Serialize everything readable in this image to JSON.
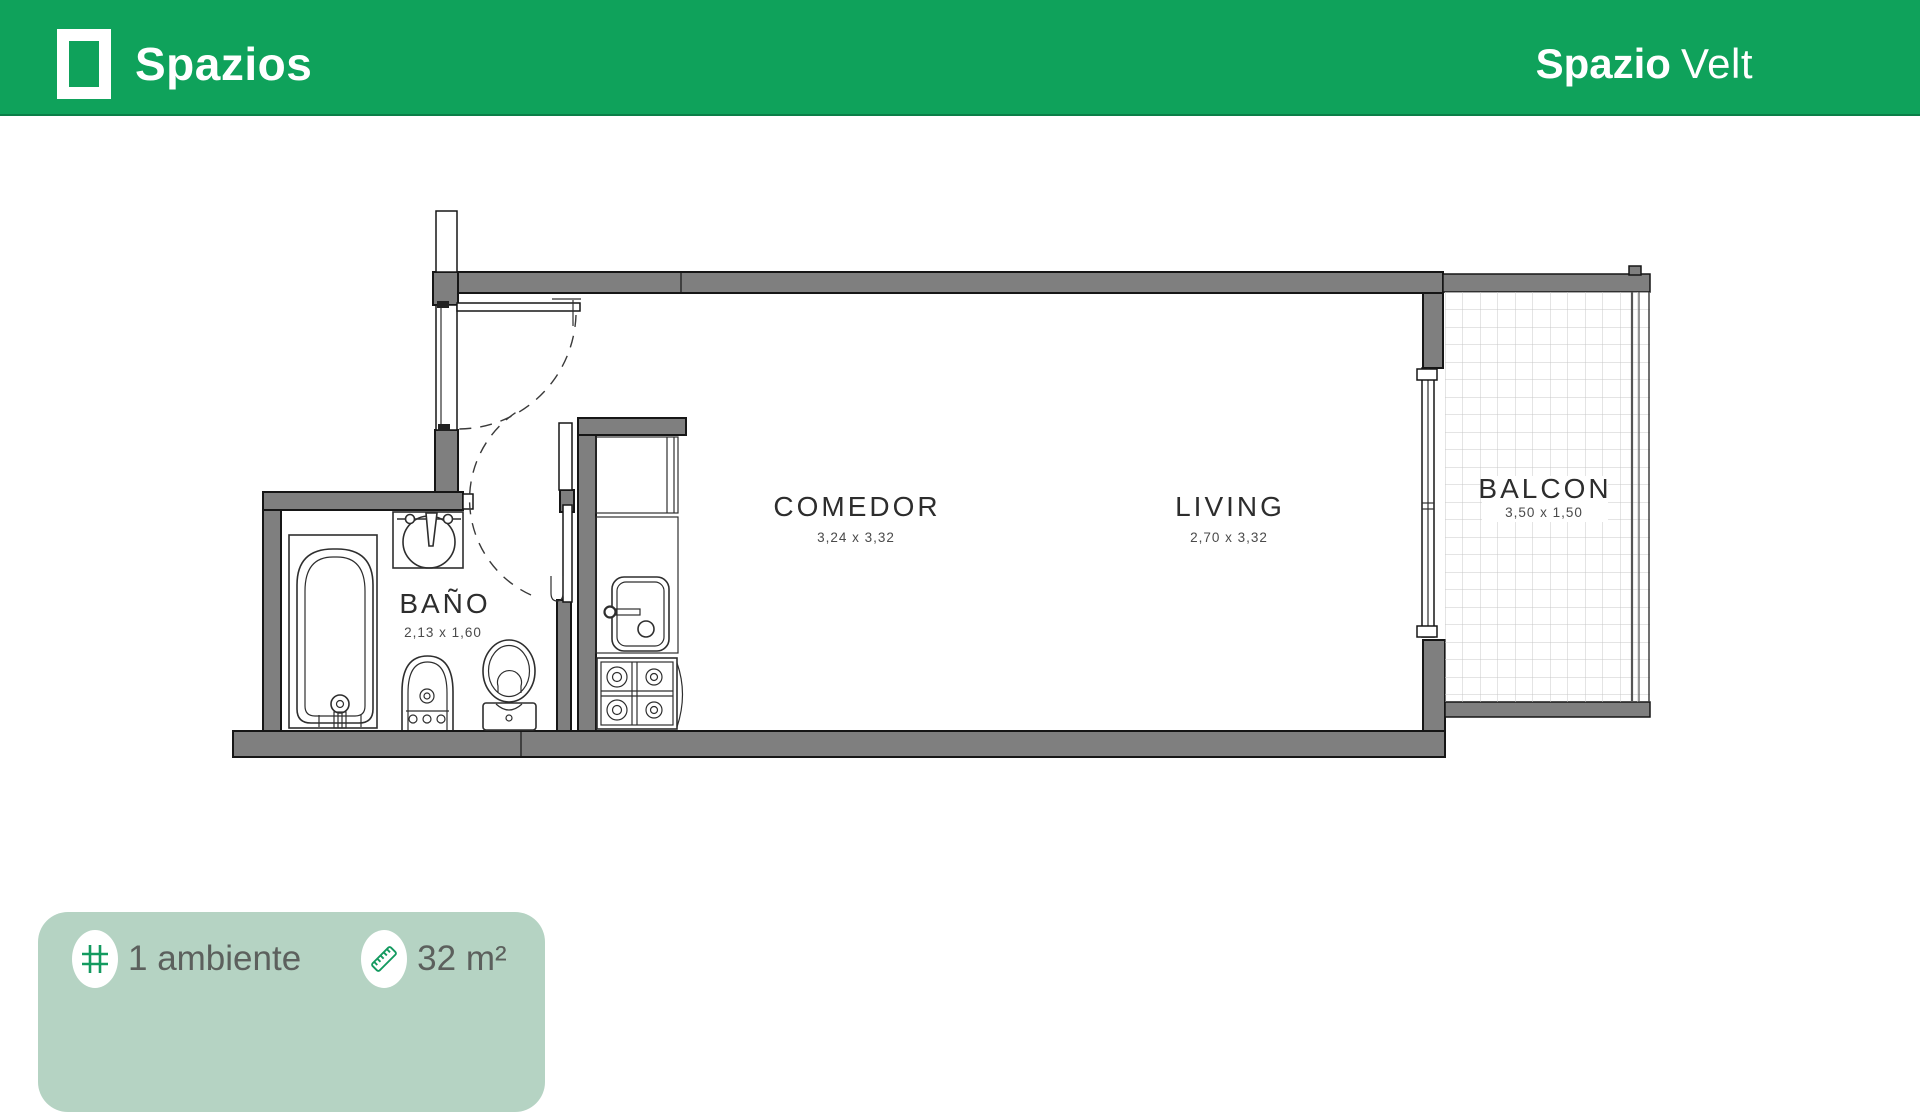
{
  "header": {
    "brand": "Spazios",
    "unit_bold": "Spazio",
    "unit_light": "Velt"
  },
  "plan": {
    "rooms": [
      {
        "id": "bano",
        "name": "BAÑO",
        "dims": "2,13 x 1,60"
      },
      {
        "id": "comedor",
        "name": "COMEDOR",
        "dims": "3,24 x 3,32"
      },
      {
        "id": "living",
        "name": "LIVING",
        "dims": "2,70 x 3,32"
      },
      {
        "id": "balcon",
        "name": "BALCON",
        "dims": "3,50 x 1,50"
      }
    ],
    "fixtures": [
      "bathtub",
      "bathroom-sink",
      "bidet",
      "toilet",
      "kitchen-closet",
      "kitchen-sink",
      "stove",
      "entrance-door",
      "bathroom-door",
      "balcony-window",
      "balcony-railing"
    ]
  },
  "badge": {
    "ambientes": "1 ambiente",
    "area": "32 m²",
    "icons": [
      "grid-icon",
      "ruler-icon"
    ]
  },
  "colors": {
    "header_green": "#0fa25b",
    "badge_bg": "#b5d3c3",
    "icon_green": "#149a60",
    "wall_gray": "#7f7f7f",
    "line_dark": "#161616",
    "text_gray": "#5c605d"
  }
}
